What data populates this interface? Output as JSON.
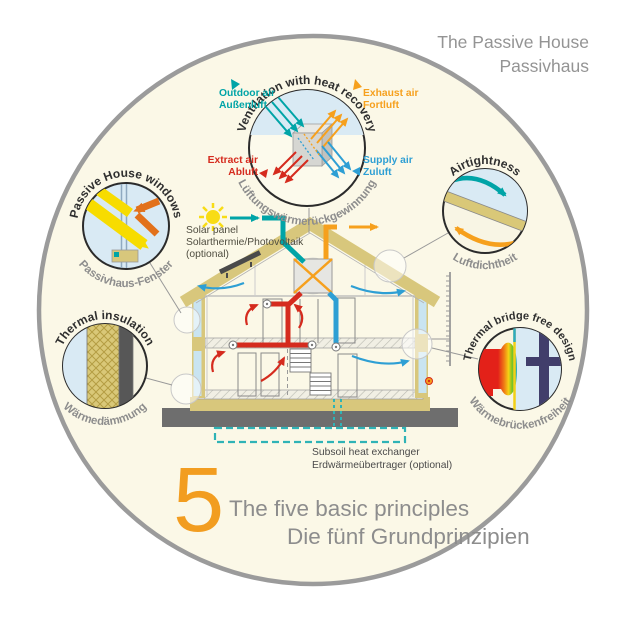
{
  "title": {
    "line1": "The Passive House",
    "line2": "Passivhaus"
  },
  "principles": {
    "ventilation": {
      "en": "Ventilation with heat recovery",
      "de": "Lüftungswärmerückgewinnung"
    },
    "windows": {
      "en": "Passive House windows",
      "de": "Passivhaus-Fenster"
    },
    "airtightness": {
      "en": "Airtightness",
      "de": "Luftdichtheit"
    },
    "insulation": {
      "en": "Thermal insulation",
      "de": "Wärmedämmung"
    },
    "thermal_bridge": {
      "en": "Thermal bridge free design",
      "de": "Wärmebrückenfreiheit"
    }
  },
  "air_flows": {
    "outdoor": {
      "en": "Outdoor air",
      "de": "Außenluft",
      "color": "#00A4A7"
    },
    "exhaust": {
      "en": "Exhaust air",
      "de": "Fortluft",
      "color": "#F6A01D"
    },
    "extract": {
      "en": "Extract air",
      "de": "Abluft",
      "color": "#D52B1E"
    },
    "supply": {
      "en": "Supply air",
      "de": "Zuluft",
      "color": "#2E9FD4"
    }
  },
  "annotations": {
    "solar": {
      "line1": "Solar panel",
      "line2": "Solarthermie/Photovoltaik",
      "line3": "(optional)"
    },
    "subsoil": {
      "line1": "Subsoil heat exchanger",
      "line2": "Erdwärmeübertrager (optional)"
    }
  },
  "footer": {
    "number": "5",
    "en": "The five basic principles",
    "de": "Die fünf Grundprinzipien"
  },
  "colors": {
    "background_circle": "#FBF8E7",
    "circle_border": "#9B9B9B",
    "structure_tan": "#D8C77C",
    "ground_gray": "#6E6E6E",
    "teal": "#00A4A7",
    "orange": "#F6A01D",
    "red": "#D52B1E",
    "blue": "#2E9FD4",
    "sky_blue": "#D9EAF4",
    "gray_text": "#8D8D8D",
    "footer_number_orange": "#F29D20"
  }
}
